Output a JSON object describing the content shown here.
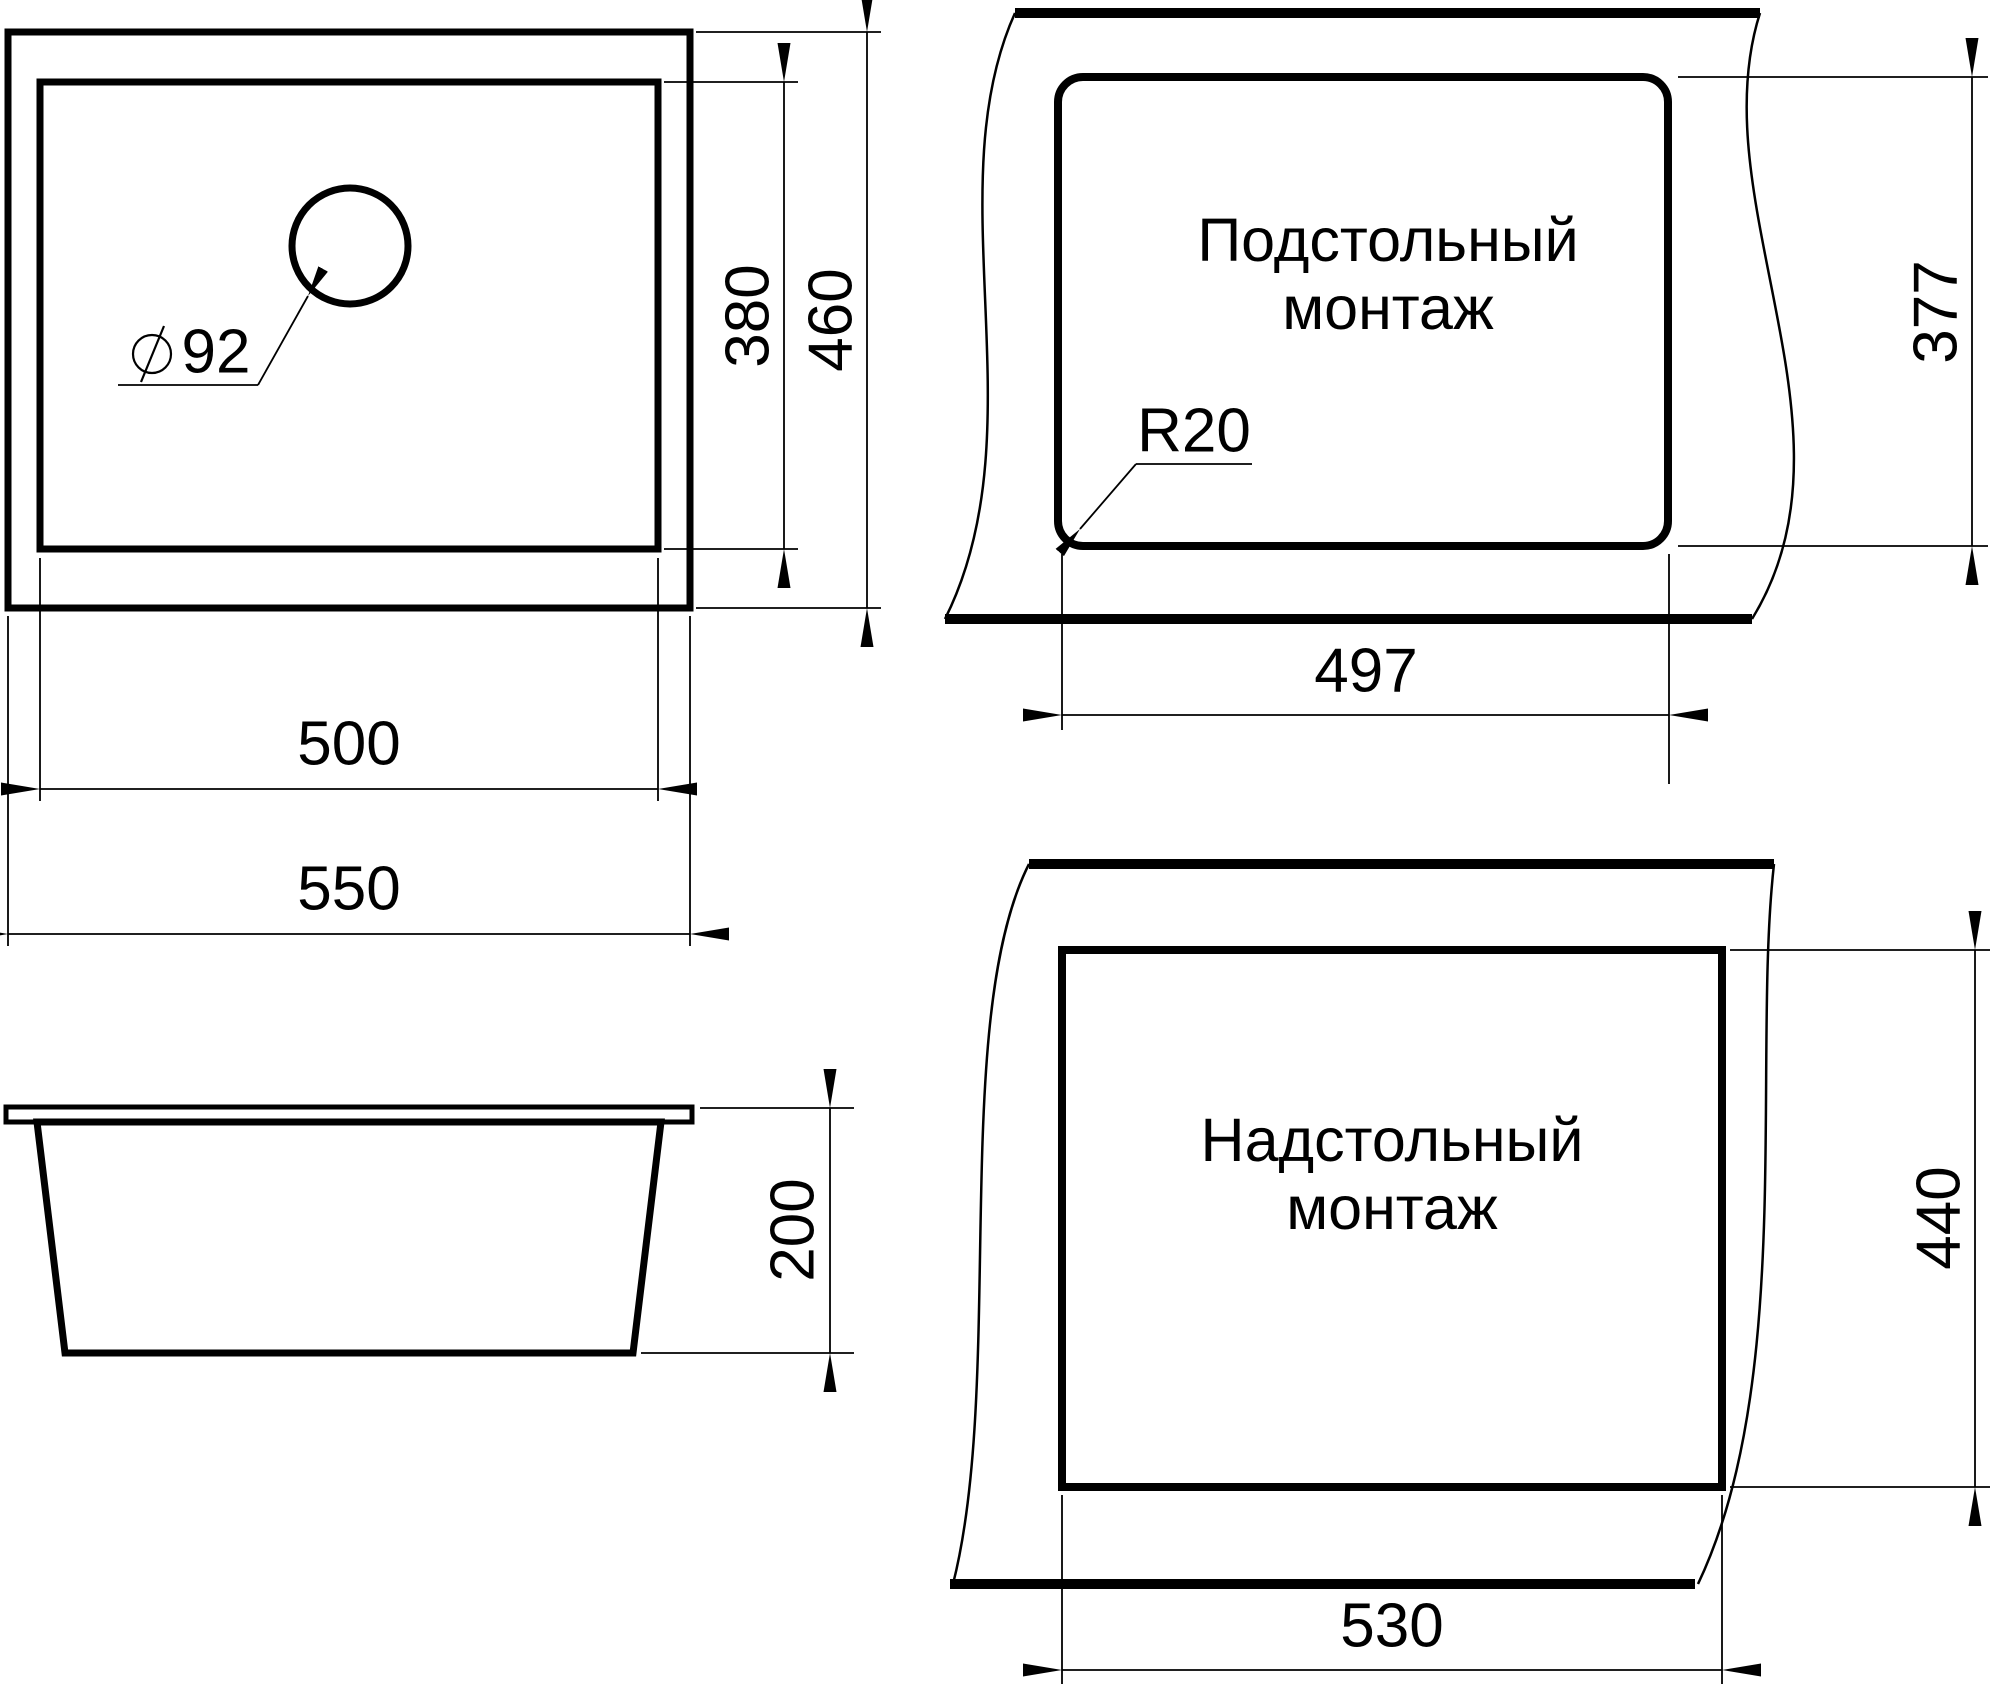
{
  "drawing": {
    "background": "#ffffff",
    "line_color": "#000000",
    "type": "sink-installation-drawing"
  },
  "top_view": {
    "hole_diameter": "92",
    "diameter_symbol": "circle-slash",
    "inner_width": "500",
    "outer_width": "550",
    "inner_depth": "380",
    "outer_depth": "460"
  },
  "undermount_view": {
    "label_line1": "Подстольный",
    "label_line2": "монтаж",
    "corner_radius": "R20",
    "cutout_width": "497",
    "cutout_height": "377"
  },
  "side_view": {
    "depth": "200"
  },
  "topmount_view": {
    "label_line1": "Надстольный",
    "label_line2": "монтаж",
    "cutout_width": "530",
    "cutout_height": "440"
  }
}
